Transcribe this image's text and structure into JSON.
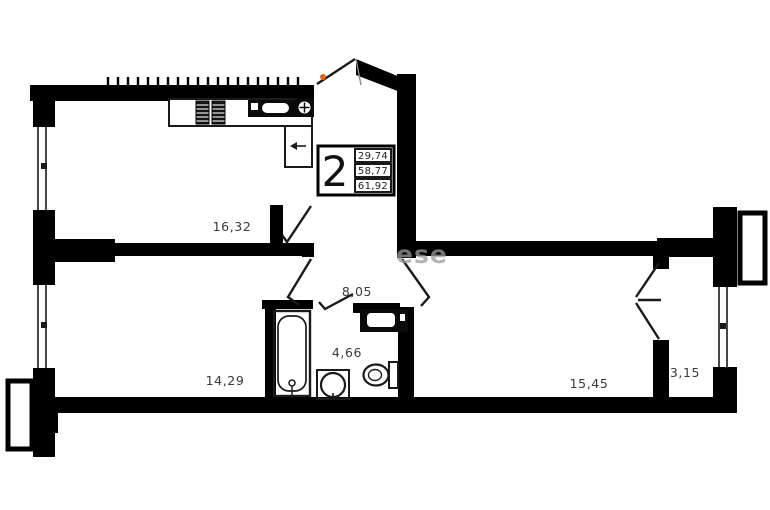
{
  "plan": {
    "title": "2-room apartment floor plan",
    "stamp": {
      "rooms_count": "2",
      "living_area": "29,74",
      "total_area": "58,77",
      "total_area_with_balcony": "61,92"
    },
    "rooms": {
      "kitchen_living": "16,32",
      "hall": "8,05",
      "bathroom": "4,66",
      "bedroom_left": "14,29",
      "bedroom_right": "15,45",
      "loggia": "3,15"
    },
    "watermark": "ese",
    "fixtures": [
      "stove-icon",
      "kitchen-sink-icon",
      "vent-icon",
      "fridge-icon",
      "bathtub-icon",
      "wash-basin-icon",
      "toilet-icon",
      "washing-machine-icon"
    ],
    "colors": {
      "wall": "#000000",
      "label": "#3a3a3a",
      "door_accent": "#e8611a",
      "watermark": "#9b9b9b"
    }
  }
}
